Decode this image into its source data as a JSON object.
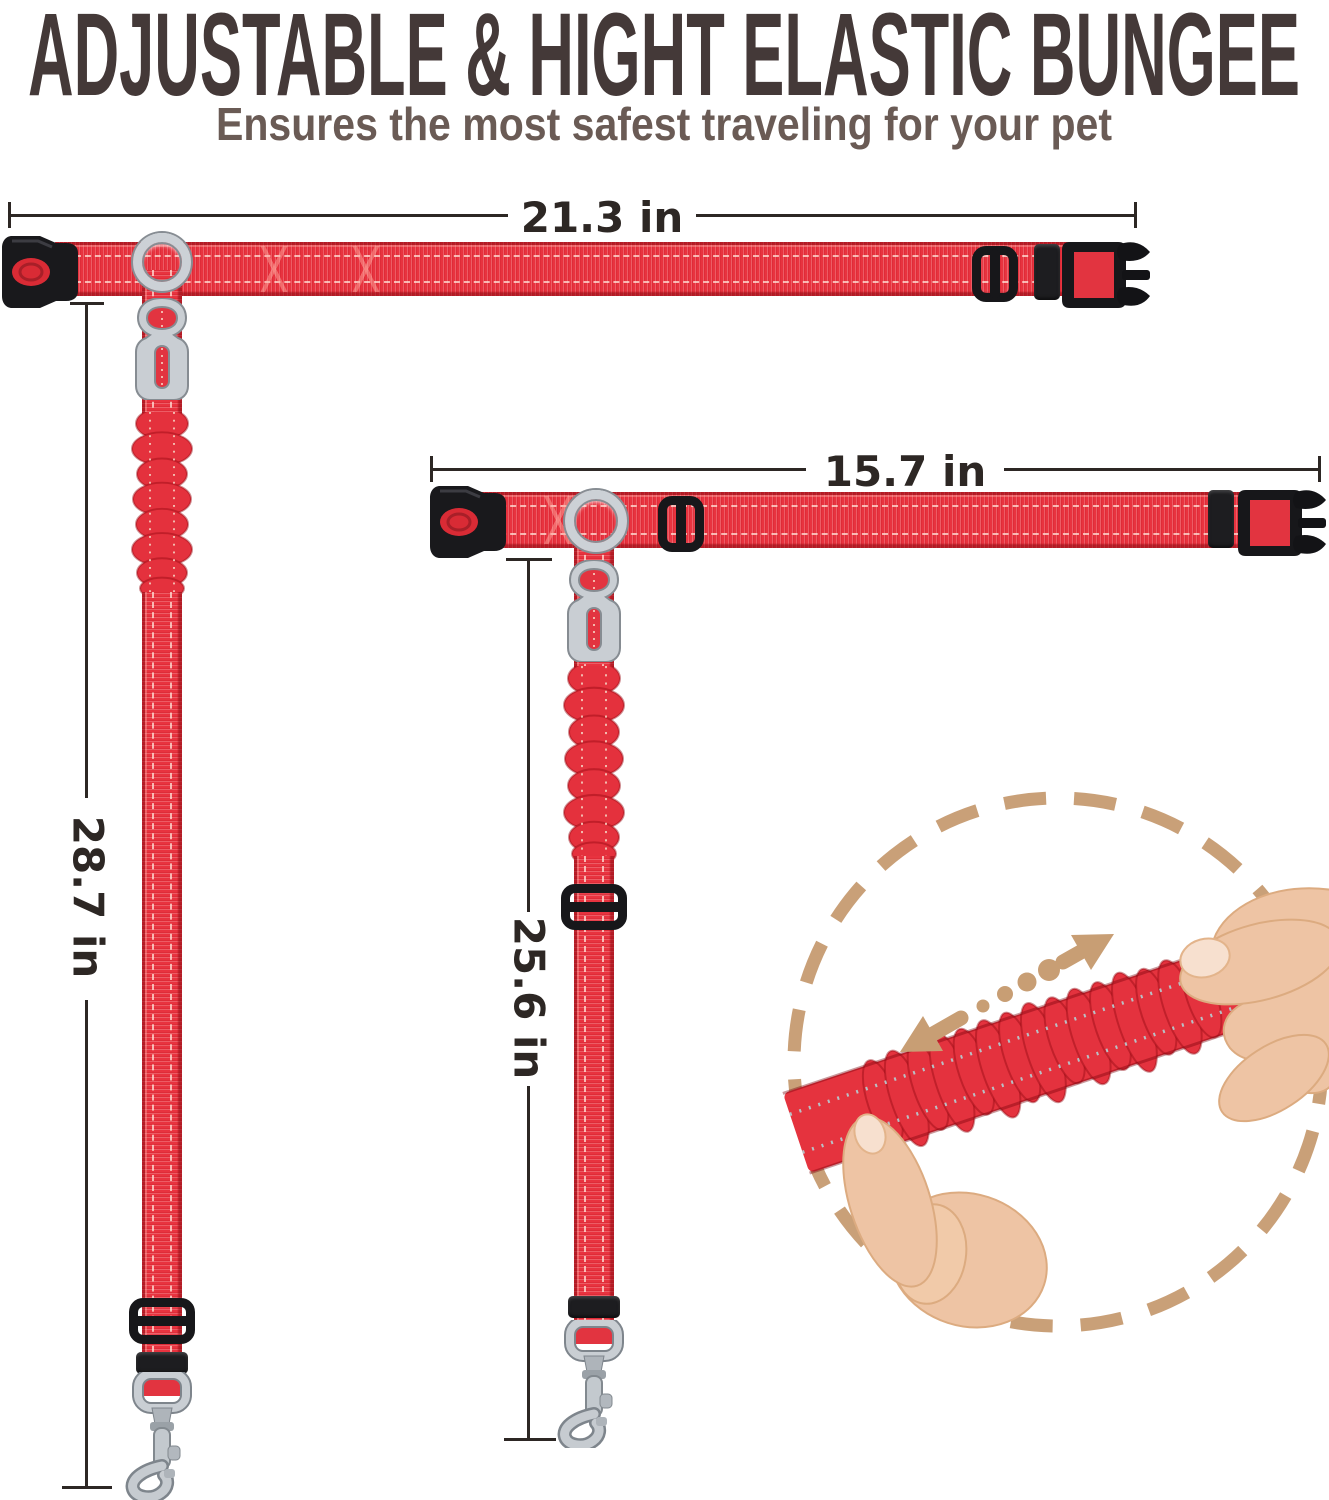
{
  "header": {
    "title": "ADJUSTABLE & HIGHT ELASTIC BUNGEE",
    "subtitle": "Ensures the most safest traveling for your pet"
  },
  "products": [
    {
      "horizontal_length": "21.3 in",
      "vertical_length": "28.7 in"
    },
    {
      "horizontal_length": "15.7 in",
      "vertical_length": "25.6 in"
    }
  ],
  "colors": {
    "strap_red": "#e8333f",
    "hardware_black": "#17171a",
    "metal_silver": "#c9ced3",
    "dimension_ink": "#2d2724",
    "title_ink": "#443938",
    "subtitle_ink": "#6a5b55",
    "inset_tan": "#c9a078",
    "skin": "#eec4a4"
  }
}
